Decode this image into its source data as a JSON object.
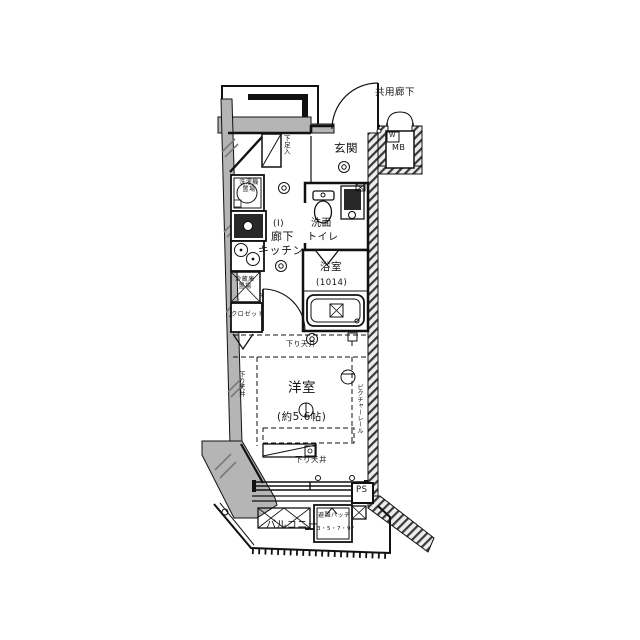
{
  "colors": {
    "background": "#ffffff",
    "wall_fill": "#b5b5b5",
    "line": "#1a1a1a",
    "hatch_dark": "#3a3a3a",
    "sink_dark": "#282828"
  },
  "exterior": {
    "common_corridor": "共用廊下",
    "meter_box": "MB",
    "water_meter": "W",
    "pipe_space": "PS",
    "balcony": "バルコニー",
    "escape_hatch": "避難ハッチ",
    "escape_hatch_floors": "3・5・7・9F"
  },
  "rooms": {
    "entrance": "玄関",
    "hall": "廊下",
    "kitchen": "キッチン",
    "hall_mark": "(Ⅰ)",
    "washroom_1": "洗面",
    "washroom_2": "トイレ",
    "bath": "浴室",
    "bath_size": "(1014)",
    "western_room": "洋室",
    "western_room_size": "(約5.6帖)"
  },
  "features": {
    "shoe_box": "下足入",
    "washer_place_1": "洗濯機",
    "washer_place_2": "置場",
    "fridge_place_1": "冷蔵庫",
    "fridge_place_2": "置場",
    "closet": "クロゼット",
    "lowered_ceiling": "下り天井",
    "picture_rail": "ピクチャーレール",
    "door_mark": "R"
  }
}
